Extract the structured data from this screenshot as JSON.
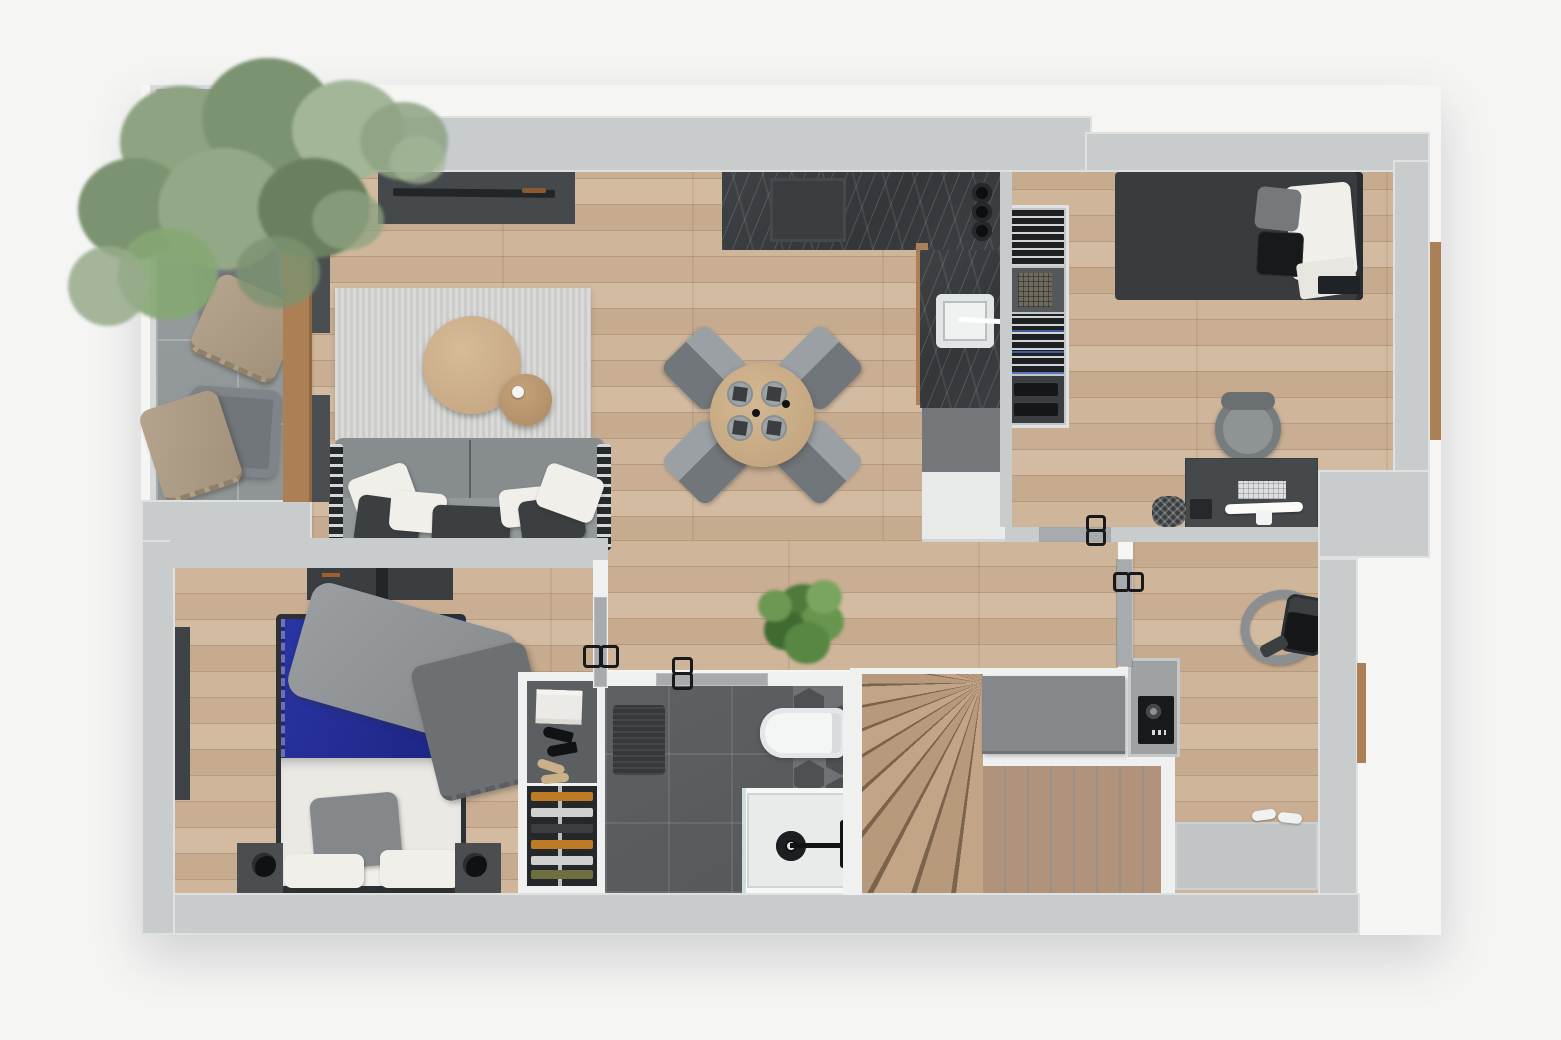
{
  "meta": {
    "title": "Apartment floor plan — photorealistic 3D top-down render",
    "notes": "No text labels are visible in the image; scene is a furnished one-floor apartment with terrace and staircase."
  },
  "palette": {
    "bg": "#f5f5f4",
    "wall": "#c9cccd",
    "wallwhite": "#eff0f0",
    "leaf": "#a7abad",
    "wood": "#c9ae93",
    "marble": "#33373a",
    "tile": "#575b5d",
    "stair": "#b0937a",
    "white": "#eceeee",
    "sofa": "#8d9295",
    "dark": "#3b3f42",
    "blue": "#222c8f",
    "tree": "#8ea382",
    "plant": "#55823f",
    "woodstrip": "#ad7f54",
    "console": "#46494c"
  },
  "rooms": {
    "terrace": {
      "label": "Terrace with large tree and two lounge chairs with throw blankets"
    },
    "living": {
      "label": "Living room with TV console, striped rug, round coffee tables and gray sofa"
    },
    "kitchen": {
      "label": "L-shaped kitchen with dark stone counters, cooktop, sink and cabinets"
    },
    "dining": {
      "label": "Dining area with round wooden table and four gray chairs set for four"
    },
    "bedroom_right": {
      "label": "Bedroom and office with single bed, open wardrobe, desk, monitor and chair"
    },
    "bedroom_left": {
      "label": "Bedroom with double bed, blue duvet, gray throw, nightstands and lamps"
    },
    "closet": {
      "label": "Wardrobe cabinet with folded clothes, heels and shoe shelves"
    },
    "bathroom": {
      "label": "Bathroom with dark tiles, hex accent, toilet, bath mat and walk-in shower"
    },
    "hall": {
      "label": "Hallway with green potted plant"
    },
    "stairs": {
      "label": "Wooden winder staircase with half wall"
    },
    "utility": {
      "label": "Landing room with vacuum cleaner, safe niche and entry mat"
    }
  },
  "furniture": {
    "living": [
      "tv-console",
      "tv",
      "rug",
      "coffee-table",
      "side-table",
      "sofa",
      "pillows"
    ],
    "kitchen": [
      "counter-top",
      "cooktop",
      "jars",
      "counter-right",
      "sink",
      "faucet",
      "gray-cabinet",
      "white-cabinet"
    ],
    "dining": [
      "round-table",
      "chair x4",
      "place-setting x4",
      "candles"
    ],
    "bedroom_right": [
      "single-bed",
      "white-pillow",
      "gray-pillow",
      "black-cushion",
      "wardrobe",
      "desk",
      "keyboard",
      "monitor",
      "desk-chair",
      "waste-basket"
    ],
    "bedroom_left": [
      "double-bed",
      "blue-duvet",
      "gray-throw",
      "dark-blanket",
      "white-duvet",
      "pillow",
      "nightstand x2",
      "lamp x2",
      "wall-shelf",
      "window"
    ],
    "bathroom": [
      "toilet",
      "bath-mat",
      "shower-tray",
      "drain",
      "shower-bar",
      "hex-tiles"
    ],
    "terrace": [
      "tree",
      "lounge-chair x2",
      "blanket x2"
    ],
    "utility": [
      "vacuum-cleaner",
      "safe",
      "entry-mat",
      "shoes"
    ],
    "hall": [
      "potted-plant"
    ]
  }
}
